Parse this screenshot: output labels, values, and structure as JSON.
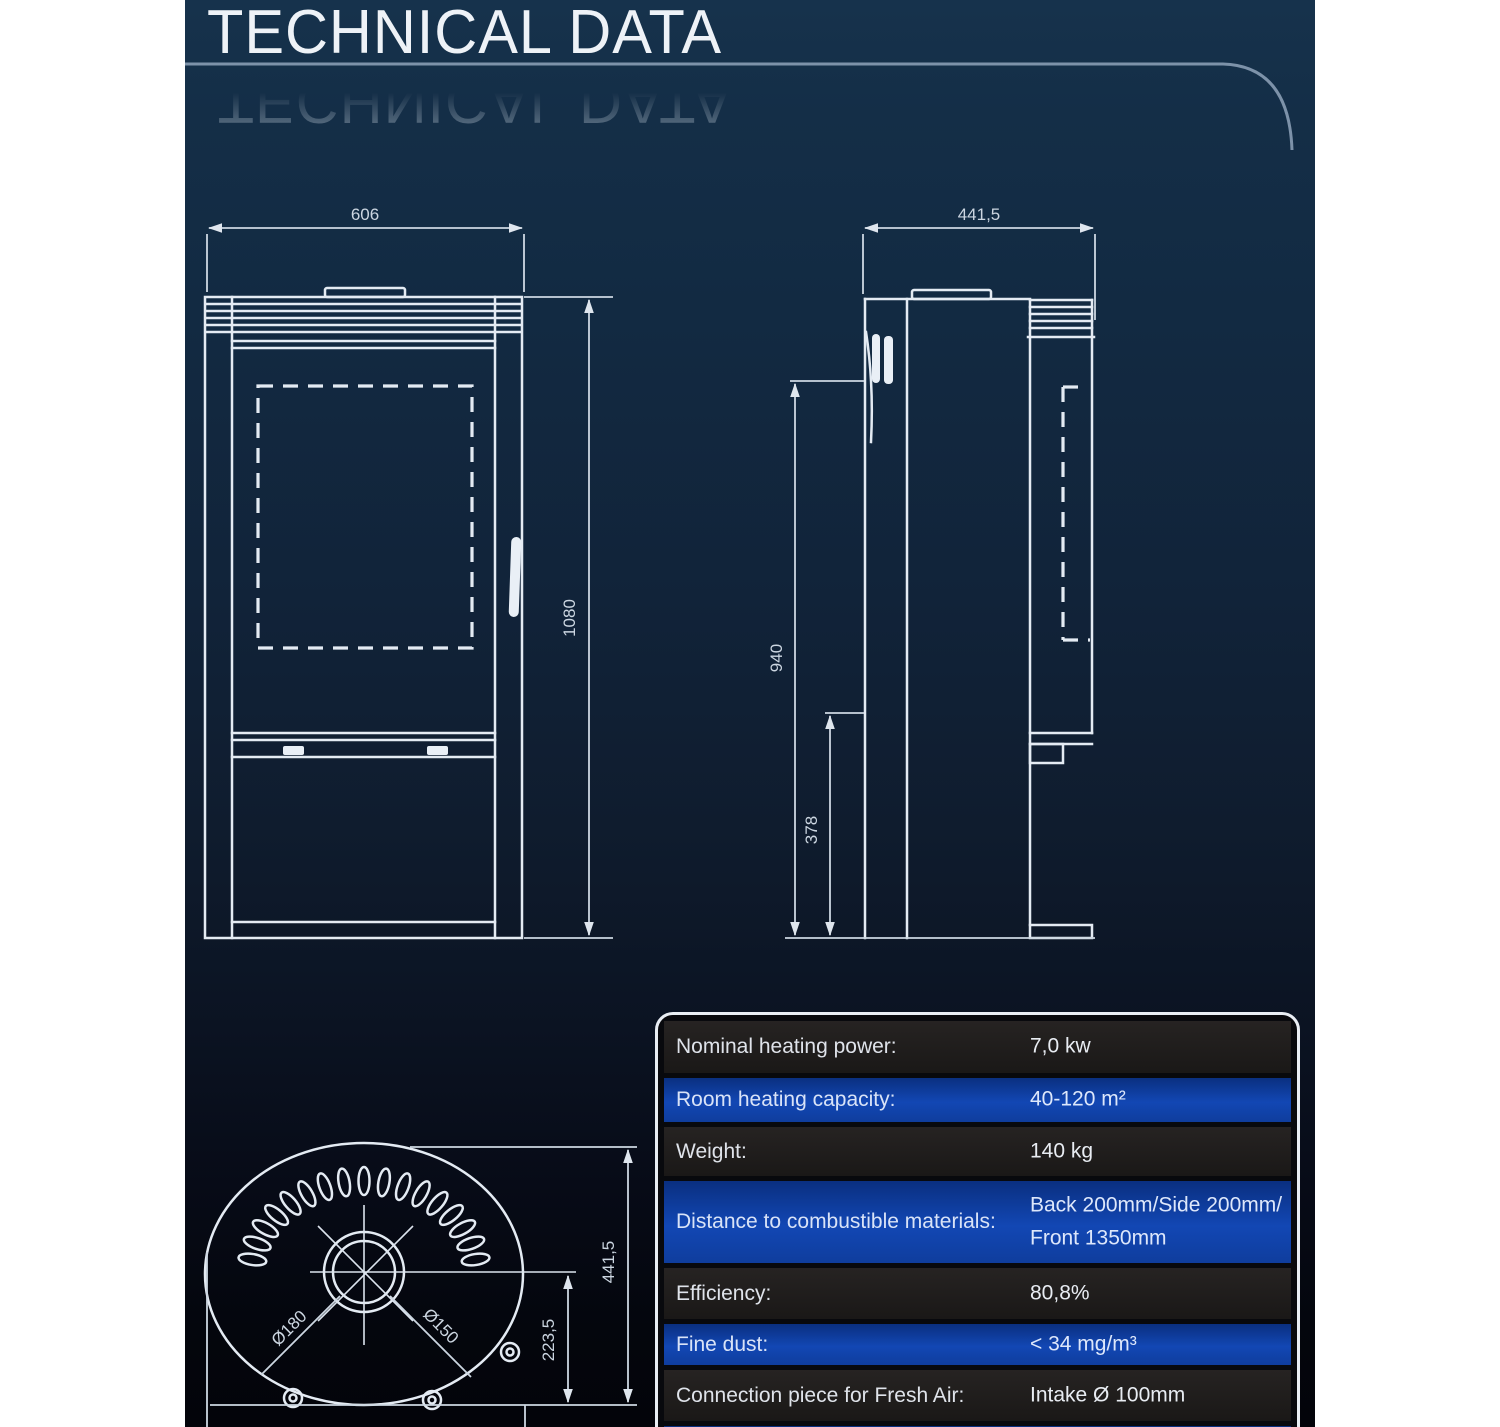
{
  "title": "TECHNICAL DATA",
  "drawings": {
    "front_view": {
      "width": "606",
      "height": "1080"
    },
    "side_view": {
      "depth": "441,5",
      "height_upper": "940",
      "height_lower": "378"
    },
    "top_view": {
      "depth": "441,5",
      "center_offset": "223,5",
      "flue_outer_diameter": "Ø180",
      "flue_inner_diameter": "Ø150"
    }
  },
  "table": {
    "rows": [
      {
        "label": "Nominal heating power:",
        "value": "7,0 kw"
      },
      {
        "label": "Room heating capacity:",
        "value": "40-120 m²"
      },
      {
        "label": "Weight:",
        "value": "140 kg"
      },
      {
        "label": "Distance to combustible materials:",
        "value": "Back 200mm/Side 200mm/",
        "value2": "Front 1350mm"
      },
      {
        "label": "Efficiency:",
        "value": "80,8%"
      },
      {
        "label": "Fine dust:",
        "value": "< 34 mg/m³"
      },
      {
        "label": "Connection piece for Fresh Air:",
        "value": "Intake Ø 100mm"
      }
    ]
  },
  "colors": {
    "background_navy": "#12283f",
    "row_dark": "#1d1b1a",
    "row_blue": "#0f40a8",
    "drawing_line": "#e4ebf3",
    "header_line": "#7d92a9"
  }
}
